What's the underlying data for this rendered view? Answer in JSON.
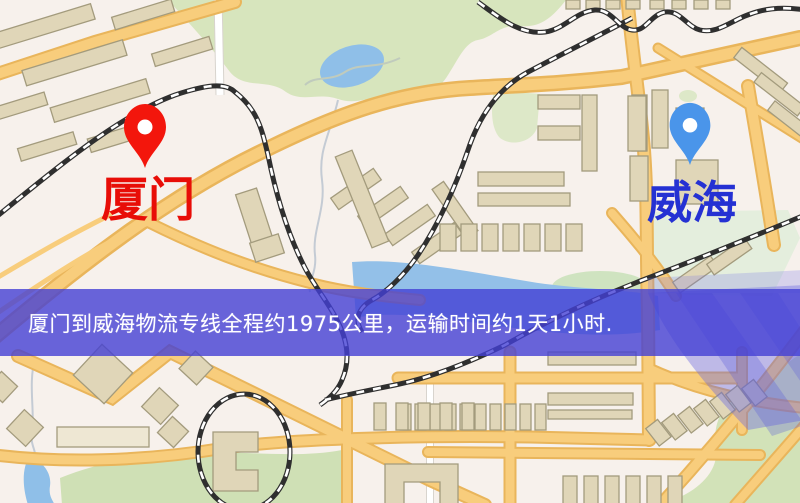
{
  "banner": {
    "text": "厦门到威海物流专线全程约1975公里，运输时间约1天1小时.",
    "background_color": "#4340d4",
    "text_color": "#ffffff"
  },
  "origin": {
    "label": "厦门",
    "label_color": "#e80d07",
    "pin_color": "#f3160c",
    "pin_icon": "red-location-pin"
  },
  "destination": {
    "label": "威海",
    "label_color": "#2531d3",
    "pin_color": "#4a95ea",
    "pin_icon": "blue-location-pin"
  },
  "map_colors": {
    "background": "#f7f1ec",
    "road_fill": "#f8cd7c",
    "road_casing": "#e9b55b",
    "building_fill": "#e0d6b8",
    "building_outline": "#a39b7d",
    "park": "#d7e5bd",
    "water": "#8fbfe8",
    "railway": "#2f2f2f",
    "highlight_overlay": "#6361de"
  }
}
